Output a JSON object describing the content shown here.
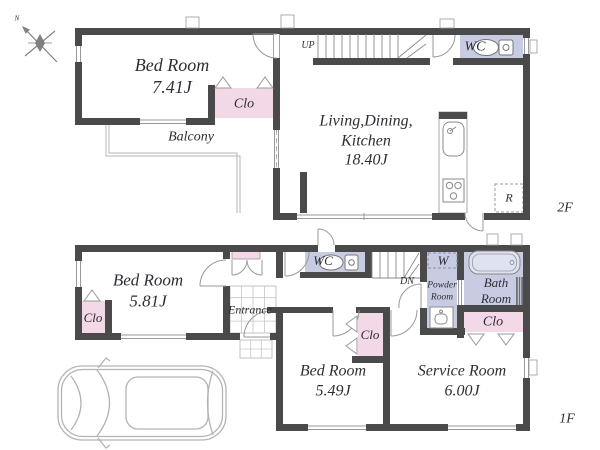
{
  "colors": {
    "wall": "#4a4a4a",
    "closet_pink": "#f3d8e7",
    "wet_area_lavender": "#c8cce3",
    "outline_gray": "#b5b5b5",
    "text": "#2e2e35"
  },
  "compass": {
    "north": "N"
  },
  "floor2": {
    "label": "2F",
    "bedroom": {
      "name": "Bed Room",
      "area": "7.41J"
    },
    "closet": {
      "label": "Clo"
    },
    "balcony": {
      "label": "Balcony"
    },
    "stairs": {
      "label": "UP"
    },
    "wc": {
      "label": "WC"
    },
    "ldk": {
      "name_line1": "Living,Dining,",
      "name_line2": "Kitchen",
      "area": "18.40J"
    },
    "refrigerator": {
      "label": "R"
    }
  },
  "floor1": {
    "label": "1F",
    "bedroom_west": {
      "name": "Bed Room",
      "area": "5.81J"
    },
    "closet_west": {
      "label": "Clo"
    },
    "entrance": {
      "label": "Entrance"
    },
    "wc": {
      "label": "WC"
    },
    "stairs": {
      "label": "DN"
    },
    "washer": {
      "label": "W"
    },
    "powder_room": {
      "name_line1": "Powder",
      "name_line2": "Room"
    },
    "bath_room": {
      "name_line1": "Bath",
      "name_line2": "Room"
    },
    "closet_hall": {
      "label": "Clo"
    },
    "closet_service": {
      "label": "Clo"
    },
    "bedroom_south": {
      "name": "Bed Room",
      "area": "5.49J"
    },
    "service_room": {
      "name": "Service Room",
      "area": "6.00J"
    }
  }
}
